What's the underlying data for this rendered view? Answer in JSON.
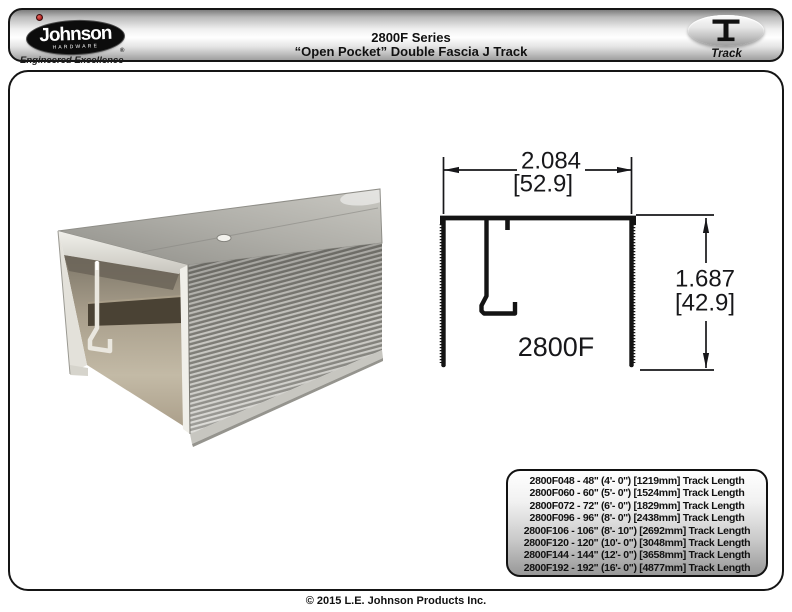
{
  "header": {
    "logo": {
      "brand": "Johnson",
      "word": "HARDWARE",
      "registered": "®",
      "tagline": "Engineered Excellence",
      "dot_color": "#b01e1e"
    },
    "title_line1": "2800F Series",
    "title_line2": "“Open Pocket” Double Fascia J Track",
    "badge": {
      "label": "Track",
      "icon": "track-cross-section-icon"
    }
  },
  "drawing": {
    "model": "2800F",
    "width_in": "2.084",
    "width_mm": "[52.9]",
    "height_in": "1.687",
    "height_mm": "[42.9]"
  },
  "parts": {
    "rows": [
      "2800F048 - 48'' (4'- 0'') [1219mm] Track Length",
      "2800F060 - 60'' (5'- 0'') [1524mm] Track Length",
      "2800F072 - 72'' (6'- 0'') [1829mm] Track Length",
      "2800F096 - 96'' (8'- 0'') [2438mm] Track Length",
      "2800F106 - 106\" (8'- 10\") [2692mm] Track Length",
      "2800F120 - 120\" (10'- 0\") [3048mm] Track Length",
      "2800F144 - 144\" (12'- 0\") [3658mm] Track Length",
      "2800F192 - 192\" (16'- 0\") [4877mm] Track Length"
    ]
  },
  "footer": {
    "copyright": "© 2015 L.E. Johnson Products Inc."
  },
  "colors": {
    "panel_gradient_bottom": "#989898",
    "line_color": "#151515"
  }
}
